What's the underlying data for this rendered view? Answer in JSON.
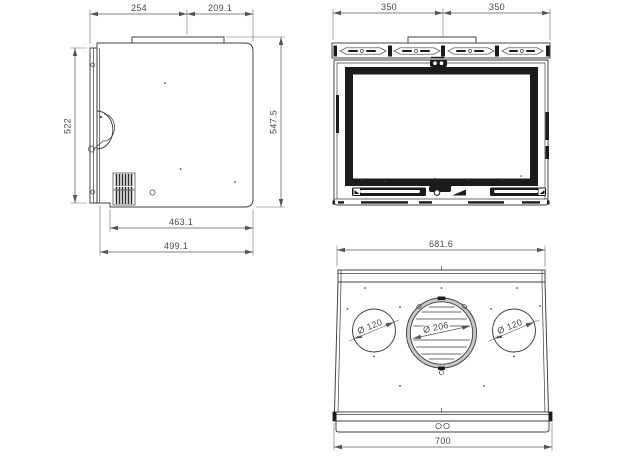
{
  "side_view": {
    "dims": {
      "top_front": "254",
      "top_rear": "209.1",
      "height_door": "522",
      "height_total": "547.5",
      "depth_body": "463.1",
      "depth_total": "499.1"
    }
  },
  "front_view": {
    "dims": {
      "width_left": "350",
      "width_right": "350"
    }
  },
  "top_view": {
    "dims": {
      "width_rear": "681.6",
      "width_front": "700"
    },
    "diameters": {
      "left": "Ø 120",
      "center": "Ø 206",
      "right": "Ø 120"
    }
  }
}
